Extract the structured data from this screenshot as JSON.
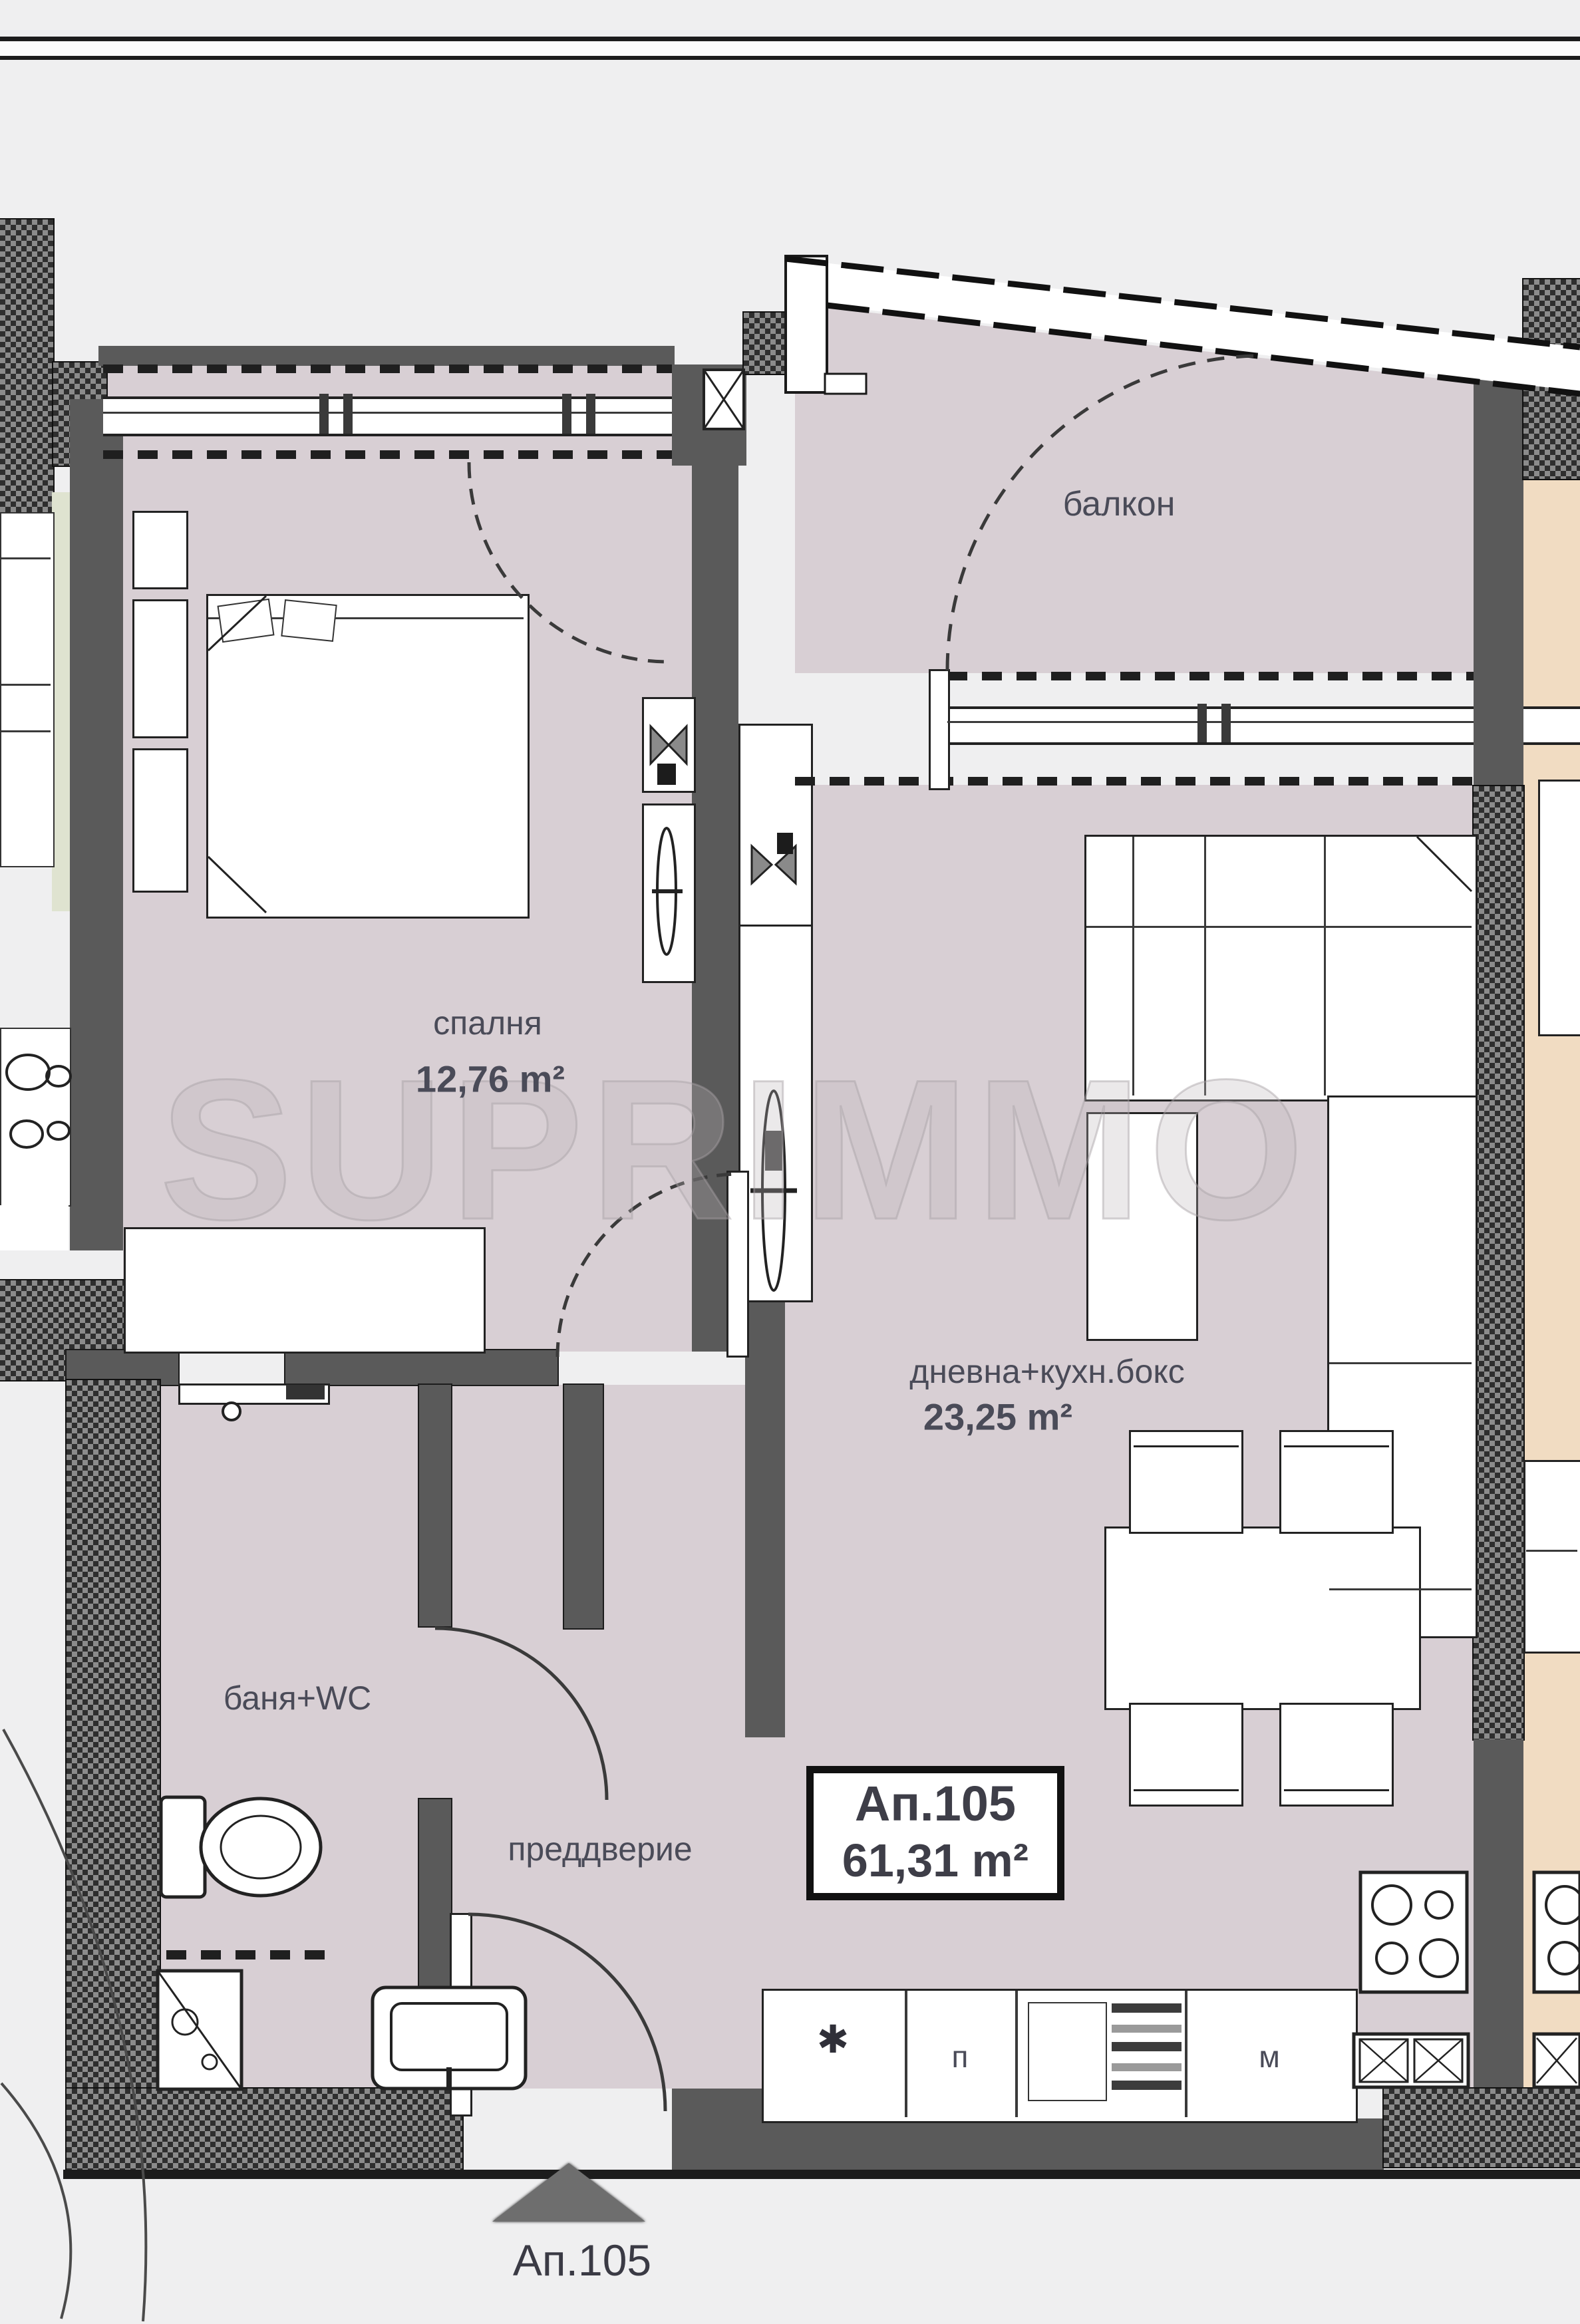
{
  "plan": {
    "type": "apartment-floor-plan",
    "watermark": "SUPRIMMO"
  },
  "rooms": {
    "balcony": {
      "label": "балкон"
    },
    "bedroom": {
      "label": "спалня",
      "area": "12,76 m²"
    },
    "living": {
      "label": "дневна+кухн.бокс",
      "area": "23,25 m²"
    },
    "bath": {
      "label": "баня+WC"
    },
    "hall": {
      "label": "преддверие"
    }
  },
  "apartment": {
    "id": "Ап.105",
    "total_area": "61,31 m²"
  },
  "entrance": {
    "label": "Ап.105"
  },
  "kitchen": {
    "sink_symbol": "✱",
    "cabinet_left": "п",
    "cabinet_right": "м"
  },
  "colors": {
    "room_fill": "#d8cfd4",
    "neighbor_fill": "#f1dcc2",
    "wall_gray": "#5a5a5a",
    "page_bg": "#efeff0",
    "label_color": "#4a4b58"
  }
}
